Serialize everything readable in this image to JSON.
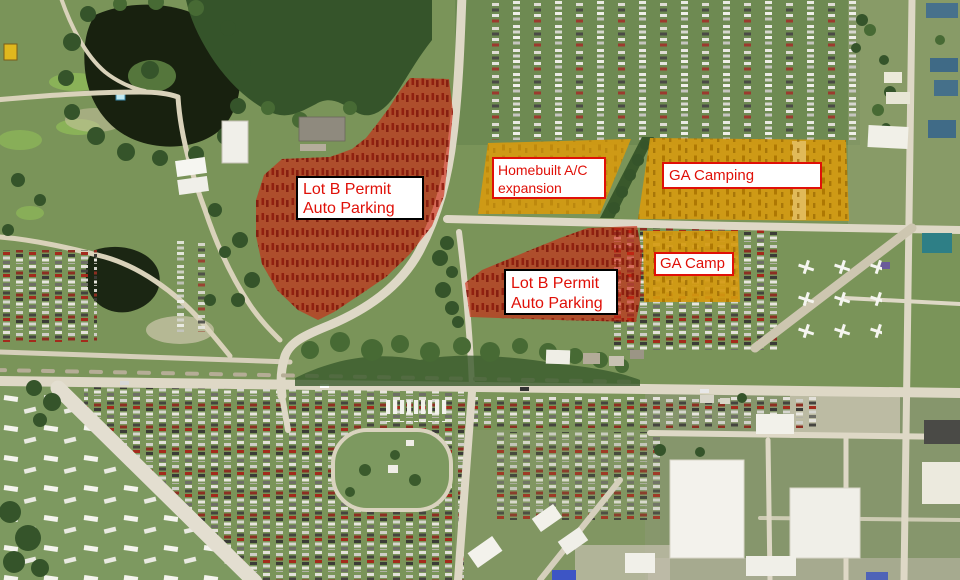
{
  "annotations": {
    "lot_b_upper": {
      "line1": "Lot B Permit",
      "line2": "Auto Parking"
    },
    "homebuilt_expansion": {
      "line1": "Homebuilt A/C",
      "line2": "expansion"
    },
    "ga_camping": {
      "label": "GA Camping"
    },
    "ga_camp": {
      "label": "GA Camp"
    },
    "lot_b_lower": {
      "line1": "Lot B Permit",
      "line2": "Auto Parking"
    }
  },
  "colors": {
    "auto_parking_overlay": "#cf2310",
    "camping_overlay": "#d59a10",
    "label_text": "#e01008",
    "label_background": "#ffffff",
    "label_border_dark": "#000000",
    "label_border_red": "#e01008"
  }
}
